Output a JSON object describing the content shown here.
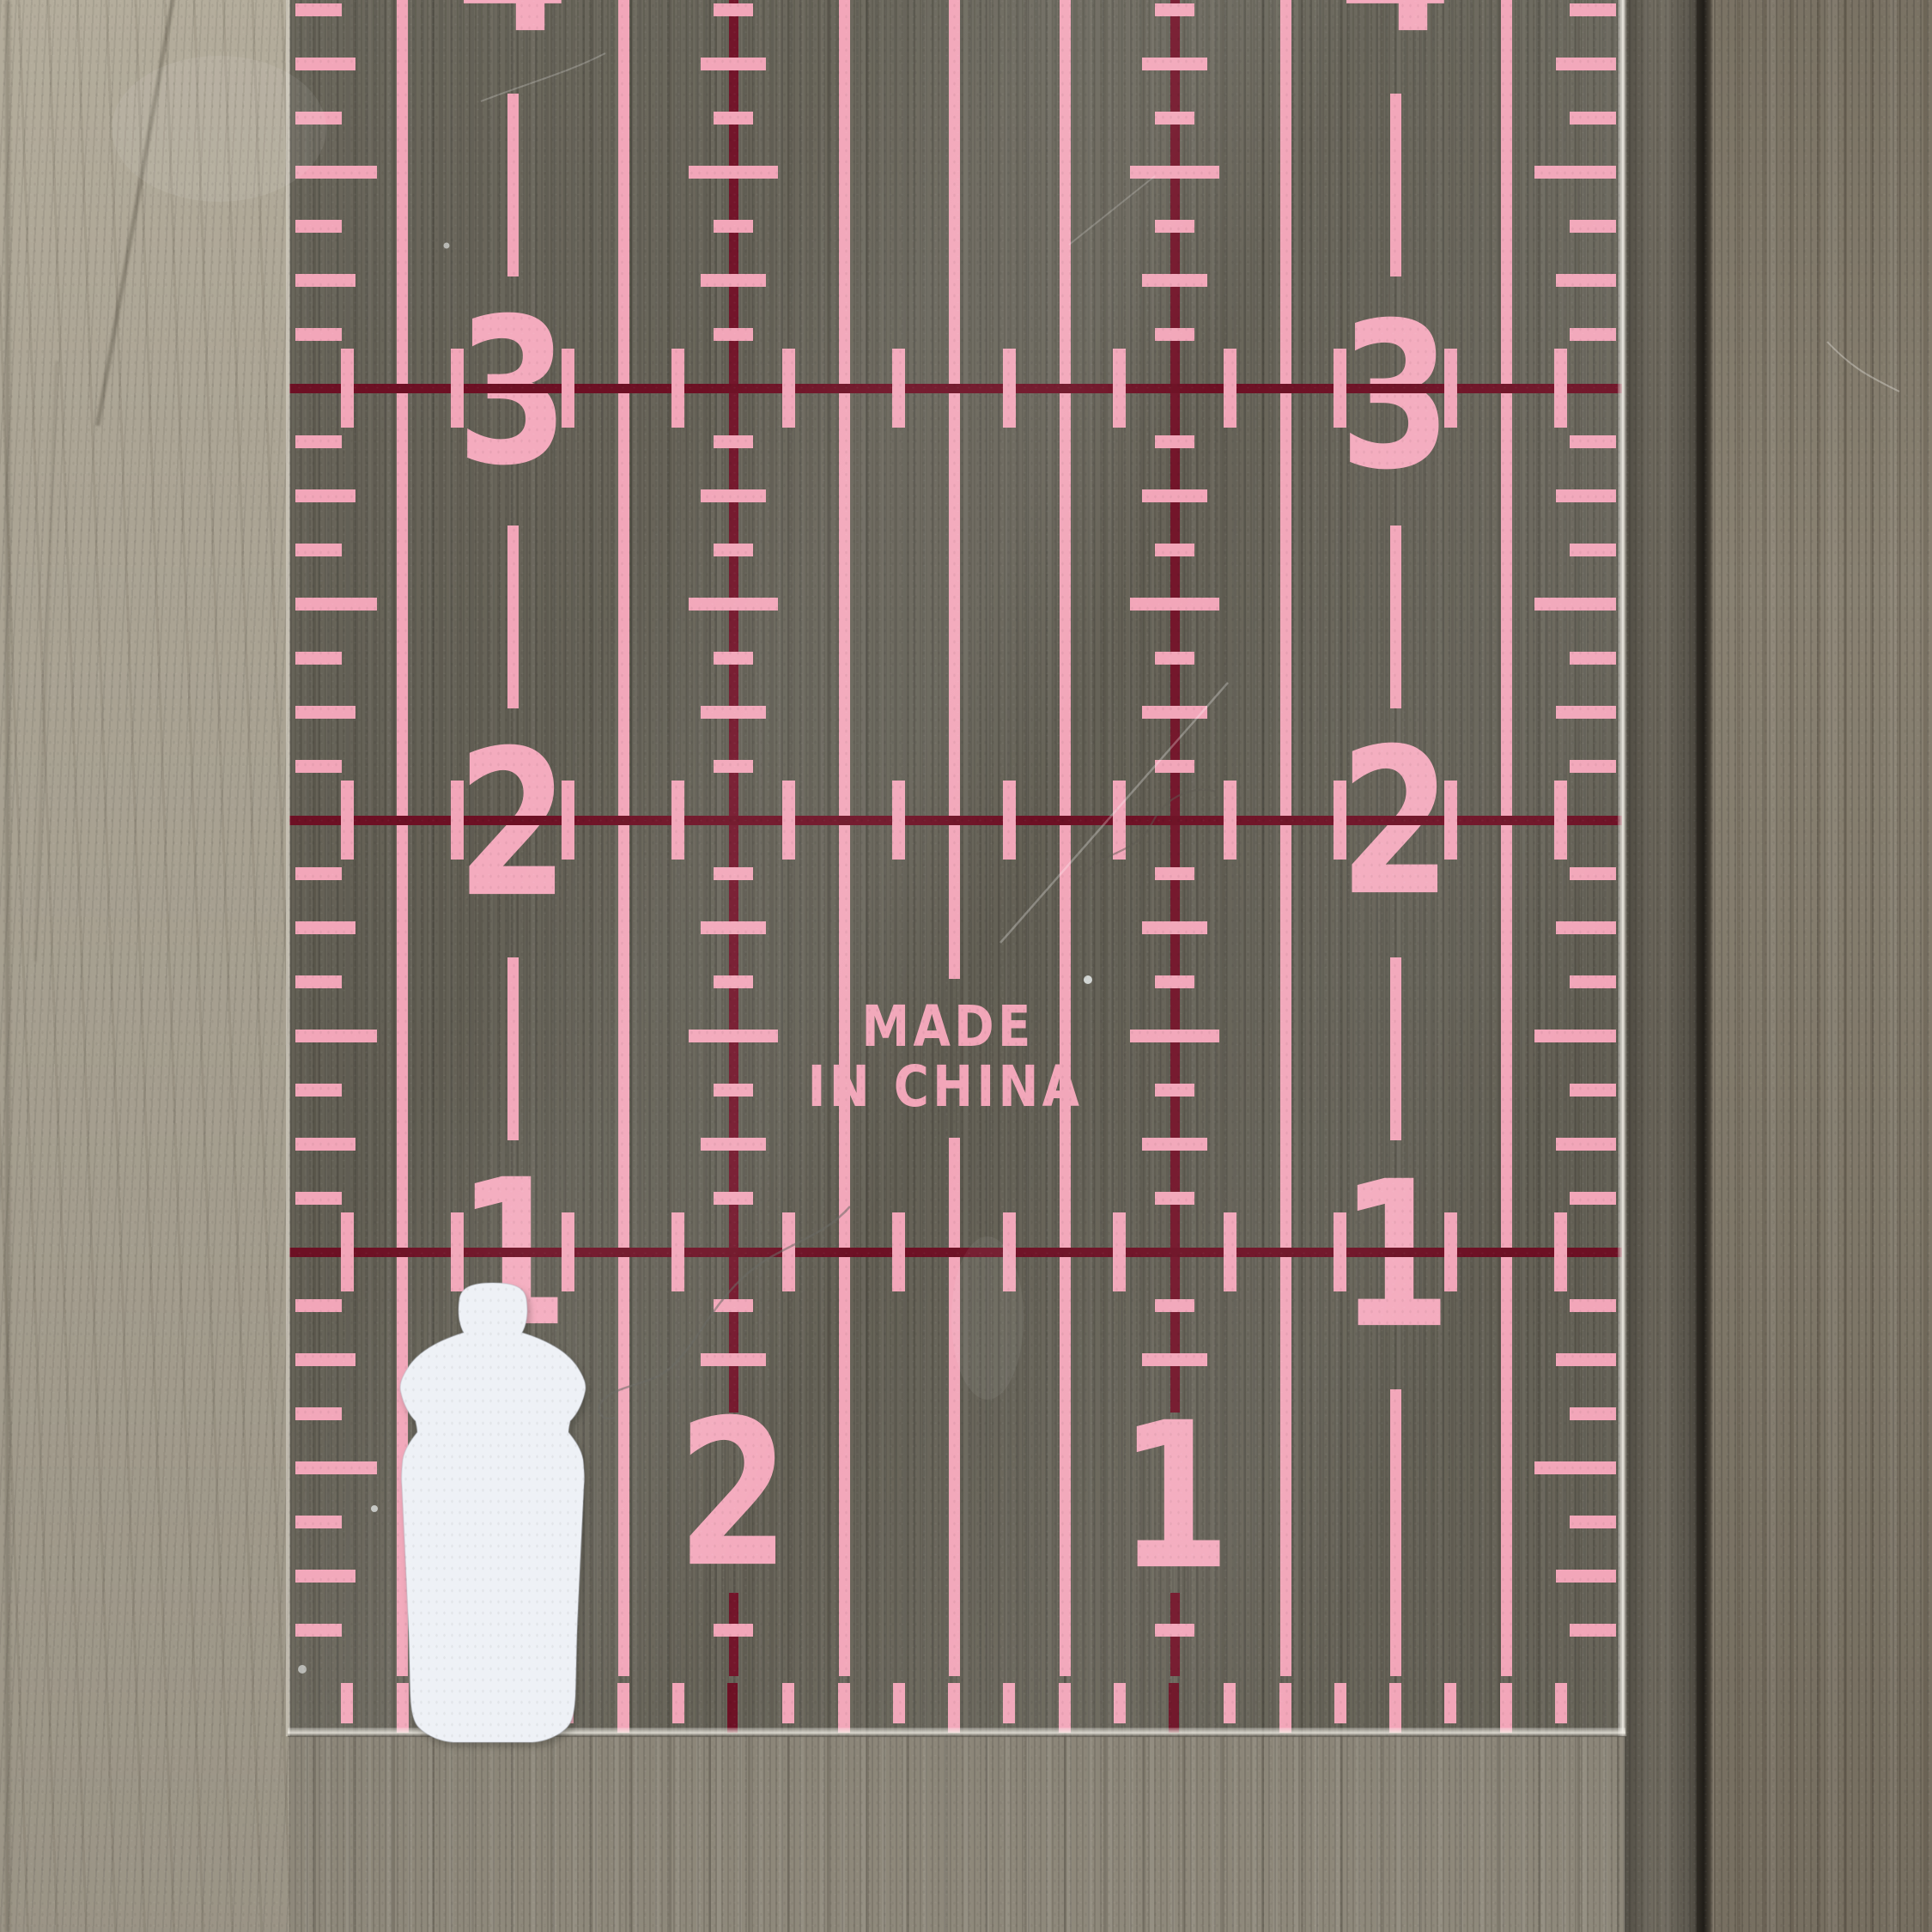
{
  "photo": {
    "subject": "clear acrylic quilting ruler with pink grid markings on wood surface",
    "ruler": {
      "left_scale_numbers": [
        "4",
        "3",
        "2",
        "1"
      ],
      "right_scale_numbers": [
        "4",
        "3",
        "2",
        "1"
      ],
      "bottom_scale_numbers": [
        "2",
        "1"
      ],
      "origin_mark_line1": "MADE",
      "origin_mark_line2": "IN CHINA",
      "colors": {
        "grid_pink": "#f2a6b9",
        "inch_maroon": "#6d1024",
        "inch_maroon_vertical": "#73152a",
        "numeral_pink": "#f4abbe"
      }
    },
    "object": {
      "name": "white baby bottle cutout",
      "color": "#eef1f6"
    }
  }
}
